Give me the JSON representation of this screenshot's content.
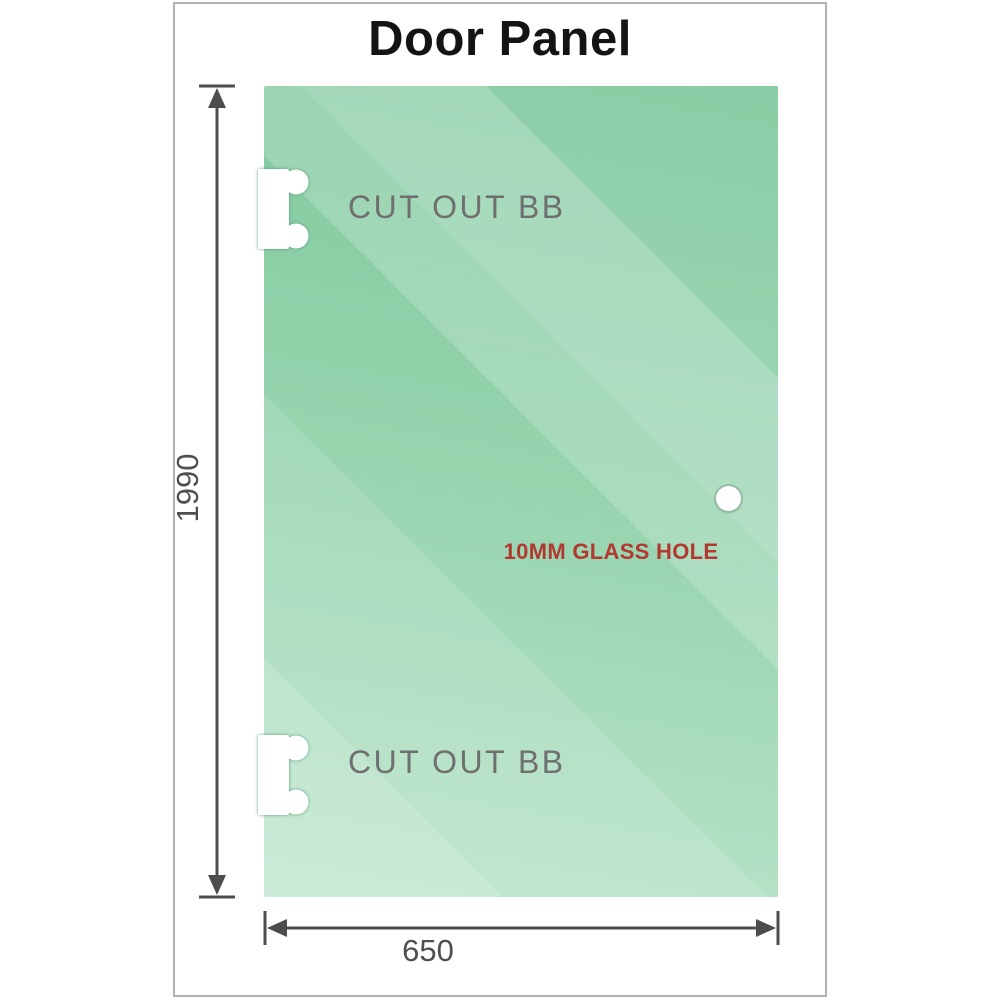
{
  "title": "Door Panel",
  "panel": {
    "top_cutout_label": "CUT OUT BB",
    "bottom_cutout_label": "CUT OUT BB",
    "hole_label": "10MM GLASS HOLE"
  },
  "dimensions": {
    "height": "1990",
    "width": "650"
  },
  "colors": {
    "glass_green_dark": "#7cc79b",
    "glass_green_light": "#b9e4ca",
    "hole_label_red": "#b23830",
    "cutout_label_gray": "#6f6f6f",
    "dimension_gray": "#4d4d4d",
    "frame_border_gray": "#b2b2b2",
    "title_black": "#141414",
    "background_white": "#ffffff"
  }
}
